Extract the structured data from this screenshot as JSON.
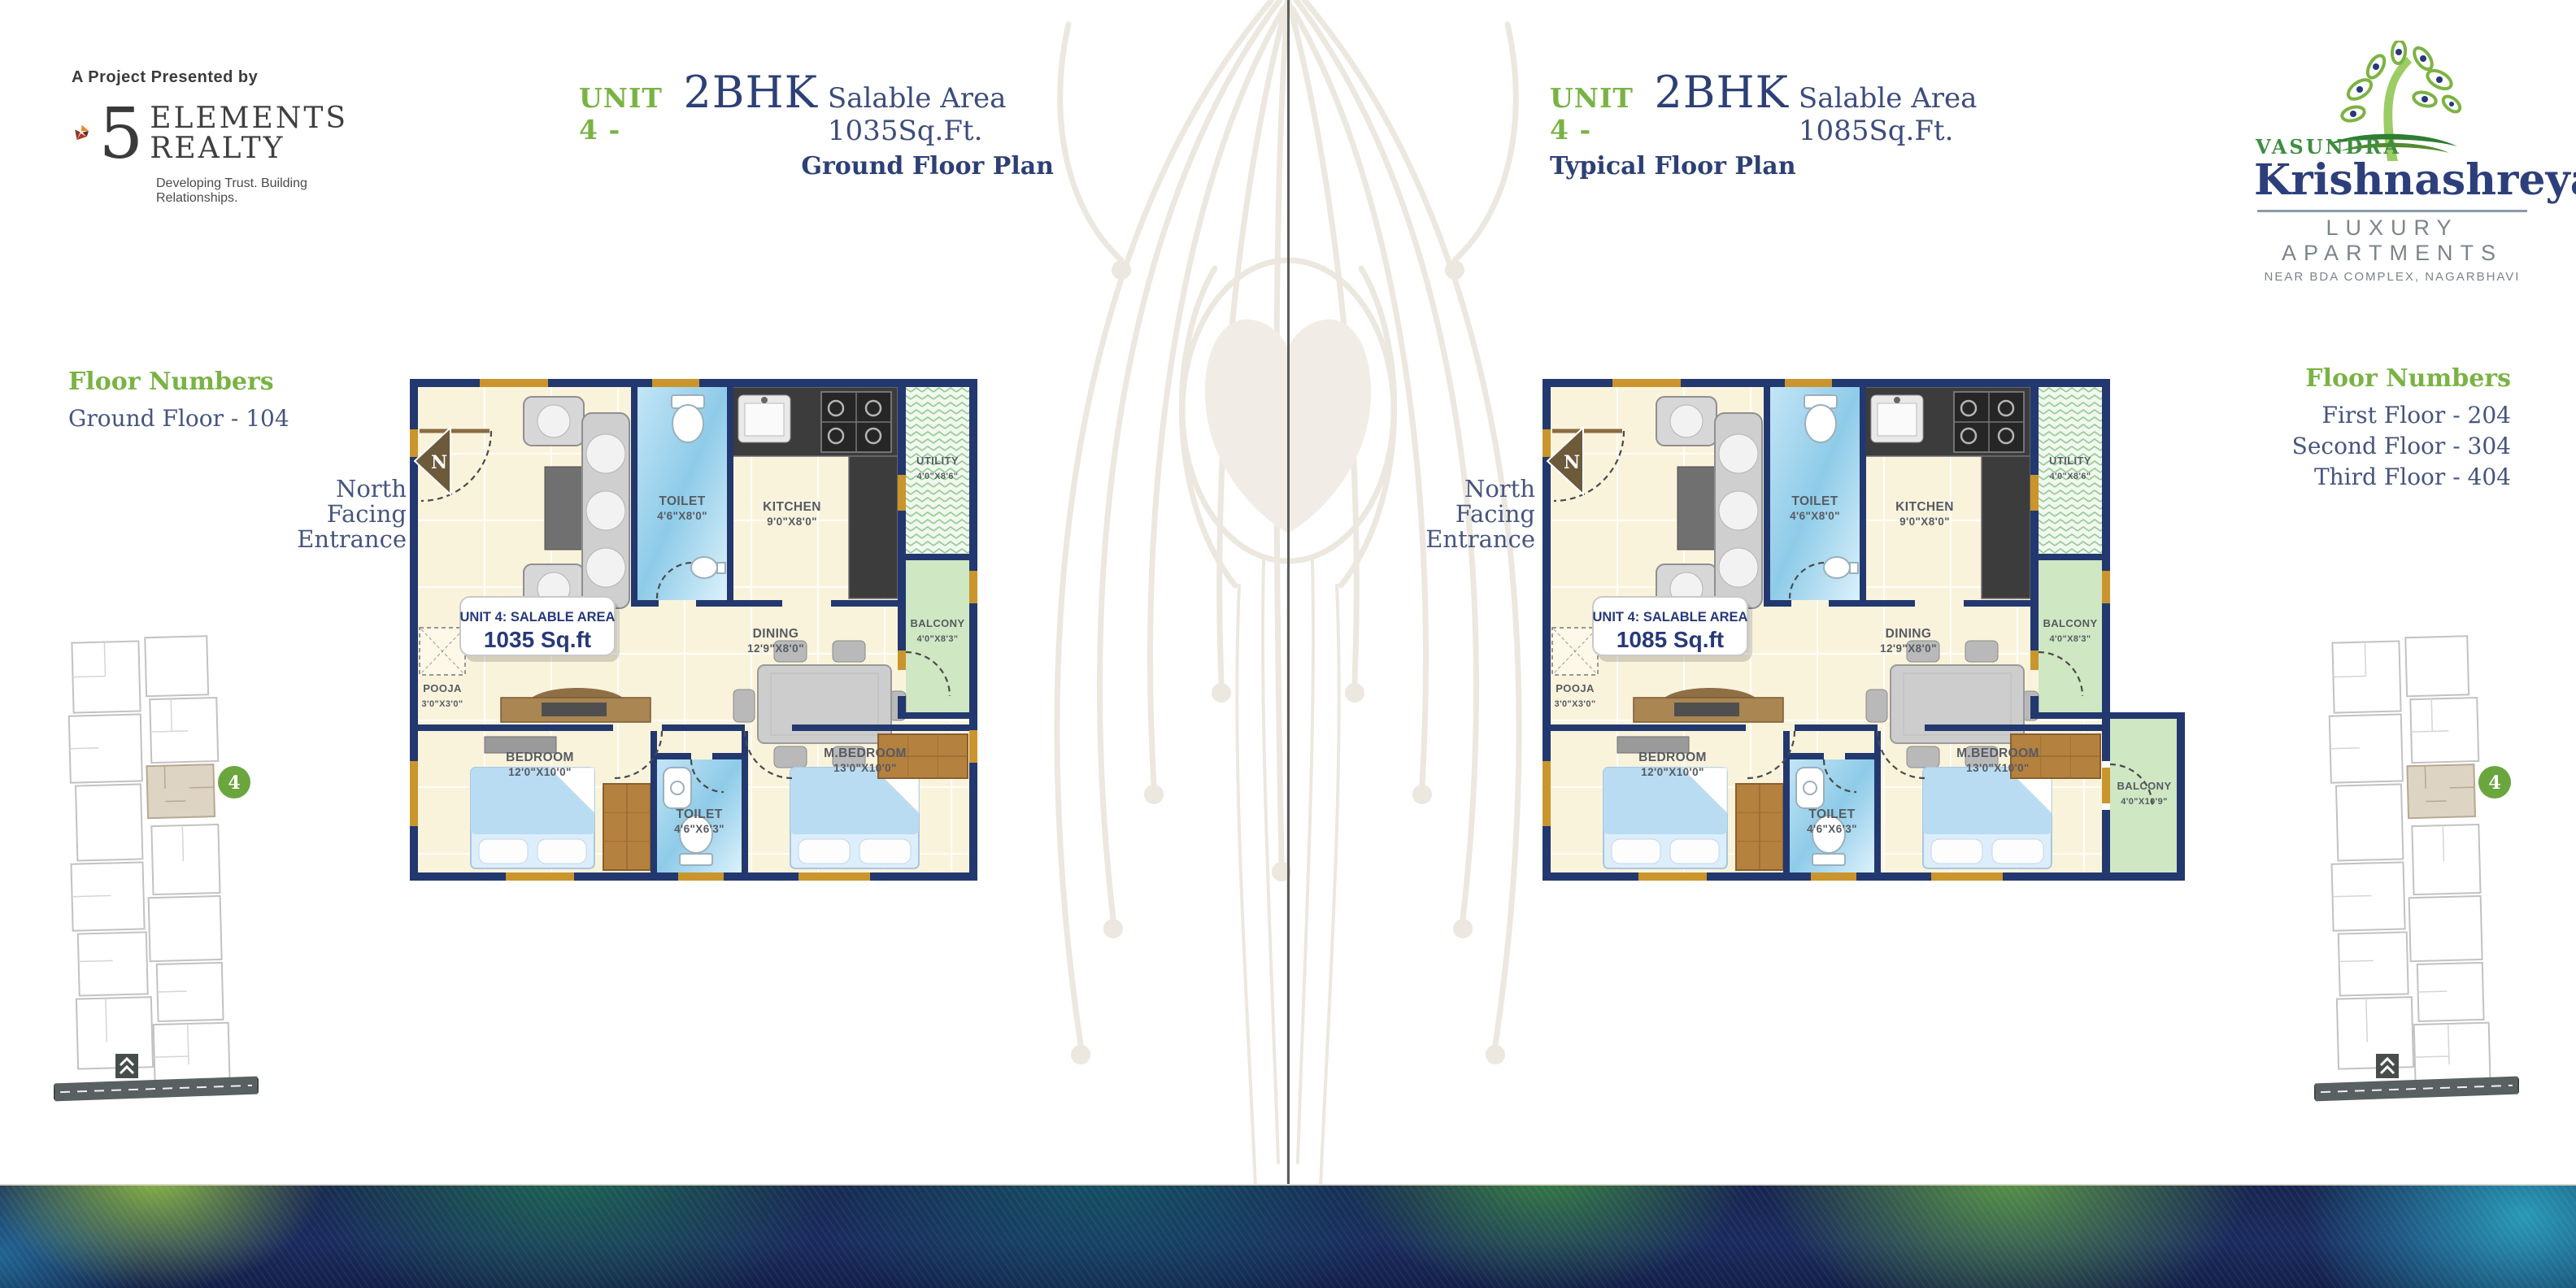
{
  "presenter": {
    "label": "A Project Presented by",
    "brand_number": "5",
    "brand_line1": "ELEMENTS",
    "brand_line2": "REALTY",
    "tagline": "Developing Trust. Building Relationships."
  },
  "developer_logo": {
    "prefix": "VASUNDRA",
    "name": "Krishnashreya",
    "type": "LUXURY APARTMENTS",
    "location": "NEAR BDA COMPLEX, NAGARBHAVI"
  },
  "left_panel": {
    "unit": "UNIT 4 -",
    "bhk": "2BHK",
    "area": "Salable Area 1035Sq.Ft.",
    "plan_type": "Ground Floor Plan",
    "floor_numbers_title": "Floor Numbers",
    "floors": [
      "Ground Floor - 104"
    ],
    "north_note": "North Facing Entrance",
    "badge_title": "UNIT 4: SALABLE AREA",
    "badge_area": "1035 Sq.ft"
  },
  "right_panel": {
    "unit": "UNIT 4 -",
    "bhk": "2BHK",
    "area": "Salable Area 1085Sq.Ft.",
    "plan_type": "Typical Floor Plan",
    "floor_numbers_title": "Floor Numbers",
    "floors": [
      "First Floor - 204",
      "Second Floor - 304",
      "Third Floor - 404"
    ],
    "north_note": "North Facing Entrance",
    "badge_title": "UNIT 4: SALABLE AREA",
    "badge_area": "1085 Sq.ft"
  },
  "rooms": {
    "living": {
      "name": "LIVING",
      "dim": "12'0\"X16'3\""
    },
    "toilet_top": {
      "name": "TOILET",
      "dim": "4'6\"X8'0\""
    },
    "kitchen": {
      "name": "KITCHEN",
      "dim": "9'0\"X8'0\""
    },
    "utility": {
      "name": "UTILITY",
      "dim": "4'0\"X8'6\""
    },
    "dining": {
      "name": "DINING",
      "dim": "12'9\"X8'0\""
    },
    "balcony": {
      "name": "BALCONY",
      "dim": "4'0\"X8'3\""
    },
    "pooja": {
      "name": "POOJA",
      "dim": "3'0\"X3'0\""
    },
    "bedroom": {
      "name": "BEDROOM",
      "dim": "12'0\"X10'0\""
    },
    "toilet_bottom": {
      "name": "TOILET",
      "dim": "4'6\"X6'3\""
    },
    "master_bedroom": {
      "name": "M.BEDROOM",
      "dim": "13'0\"X10'0\""
    },
    "balcony_extra": {
      "name": "BALCONY",
      "dim": "4'0\"X10'9\""
    }
  },
  "compass_letter": "N",
  "keyplan_unit_badge": "4",
  "colors": {
    "accent_green": "#7ab344",
    "navy": "#2d4076",
    "wall_navy": "#22386f",
    "floor_cream": "#faf3dc",
    "gold": "#c9952c",
    "toilet_blue": "#8ecbe8",
    "balcony_green": "#cfe7c3",
    "utility_green": "#8fc98f",
    "counter_dark": "#3c3c3c",
    "wood": "#b5813f",
    "keyplan_badge_green": "#6aa63d",
    "logo_orange": "#e8872b",
    "logo_red": "#b23a28"
  }
}
